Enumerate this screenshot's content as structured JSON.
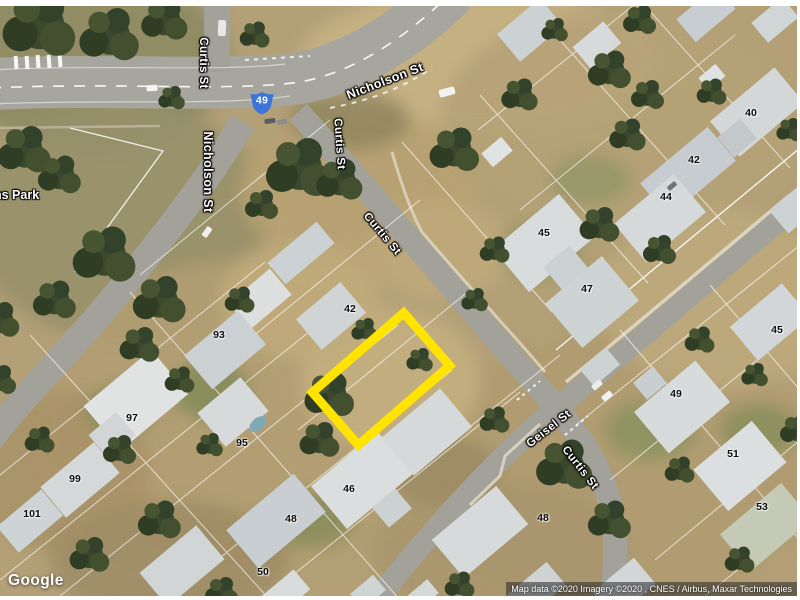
{
  "map": {
    "provider": "Google",
    "attribution": "Map data ©2020  Imagery ©2020 , CNES / Airbus, Maxar Technologies",
    "park_label": "ns Park",
    "route_marker": {
      "label": "49",
      "x": 262,
      "y": 103,
      "color": "#3d74d9"
    },
    "highlight": {
      "x": 381,
      "y": 379,
      "width": 121,
      "height": 70,
      "rotation": -41,
      "color": "#ffe400",
      "stroke_width": 9
    },
    "street_labels": [
      {
        "text": "Curtis St",
        "x": 203,
        "y": 63,
        "rotation": 90,
        "size": 11.5
      },
      {
        "text": "Nicholson St",
        "x": 385,
        "y": 81,
        "rotation": -21,
        "size": 12.5
      },
      {
        "text": "Nicholson St",
        "x": 208,
        "y": 172,
        "rotation": 90,
        "size": 12.5
      },
      {
        "text": "Curtis St",
        "x": 339,
        "y": 144,
        "rotation": 86,
        "size": 11.5
      },
      {
        "text": "Curtis St",
        "x": 382,
        "y": 234,
        "rotation": 50,
        "size": 11.5
      },
      {
        "text": "Geisel St",
        "x": 549,
        "y": 429,
        "rotation": -38,
        "size": 11.5
      },
      {
        "text": "Curtis St",
        "x": 580,
        "y": 468,
        "rotation": 52,
        "size": 11.5
      }
    ],
    "lot_numbers": [
      {
        "text": "40",
        "x": 751,
        "y": 113
      },
      {
        "text": "42",
        "x": 694,
        "y": 160
      },
      {
        "text": "44",
        "x": 666,
        "y": 197
      },
      {
        "text": "45",
        "x": 544,
        "y": 233
      },
      {
        "text": "47",
        "x": 587,
        "y": 289
      },
      {
        "text": "45",
        "x": 777,
        "y": 330
      },
      {
        "text": "49",
        "x": 676,
        "y": 394
      },
      {
        "text": "51",
        "x": 733,
        "y": 454
      },
      {
        "text": "53",
        "x": 762,
        "y": 507
      },
      {
        "text": "42",
        "x": 350,
        "y": 309
      },
      {
        "text": "93",
        "x": 219,
        "y": 335
      },
      {
        "text": "97",
        "x": 132,
        "y": 418
      },
      {
        "text": "95",
        "x": 242,
        "y": 443
      },
      {
        "text": "99",
        "x": 75,
        "y": 479
      },
      {
        "text": "101",
        "x": 32,
        "y": 514
      },
      {
        "text": "46",
        "x": 349,
        "y": 489
      },
      {
        "text": "48",
        "x": 291,
        "y": 519
      },
      {
        "text": "50",
        "x": 263,
        "y": 572
      },
      {
        "text": "48",
        "x": 543,
        "y": 518
      }
    ]
  }
}
